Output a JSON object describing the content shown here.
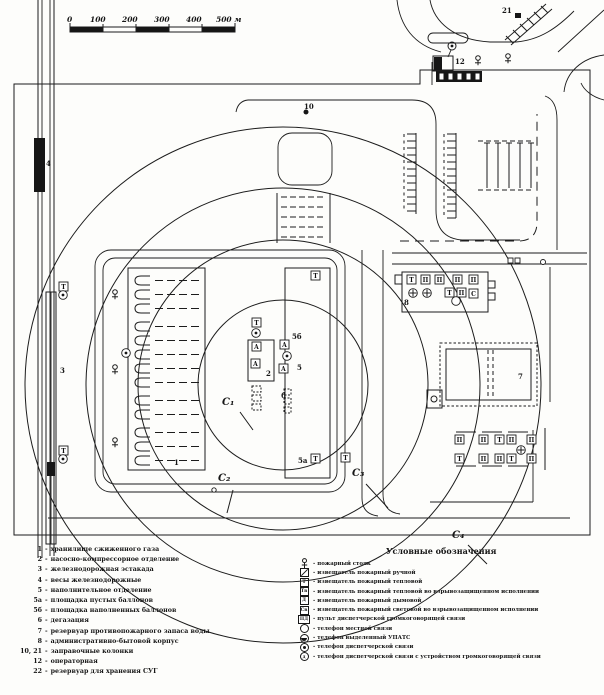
{
  "drawing": {
    "scale_bar": {
      "unit_labels": [
        "0",
        "100",
        "200",
        "300",
        "400",
        "500 м"
      ]
    },
    "map_labels": {
      "storage": "1",
      "pump": "2",
      "trestle": "3",
      "scales": "4",
      "filling": "5",
      "empty_area": "5а",
      "full_area": "5б",
      "degas": "6",
      "reservoir": "7",
      "admin": "8",
      "column10": "10",
      "operator": "12",
      "column21": "21"
    },
    "zones": {
      "z1": "С₁",
      "z2": "С₂",
      "z3": "С₃",
      "z4": "С₄"
    }
  },
  "icons": {
    "thermal": "Т",
    "thermal_ex": "Тв",
    "smoke": "Д",
    "light_ex": "Св",
    "panel": "ПД",
    "auto": "А",
    "pozh": "П",
    "svet": "С",
    "gg": "д"
  },
  "legend_left": {
    "sep": "-",
    "items": [
      {
        "num": "1",
        "text": "хранилище сжиженного газа"
      },
      {
        "num": "2",
        "text": "насосно-компрессорное отделение"
      },
      {
        "num": "3",
        "text": "железнодорожная эстакада"
      },
      {
        "num": "4",
        "text": "весы железнодорожные"
      },
      {
        "num": "5",
        "text": "наполнительное отделение"
      },
      {
        "num": "5а",
        "text": "площадка пустых баллонов"
      },
      {
        "num": "5б",
        "text": "площадка наполненных баллонов"
      },
      {
        "num": "6",
        "text": "дегазация"
      },
      {
        "num": "7",
        "text": "резервуар противопожарного запаса воды"
      },
      {
        "num": "8",
        "text": "административно-бытовой корпус"
      },
      {
        "num": "10, 21",
        "text": "заправочные колонки"
      },
      {
        "num": "12",
        "text": "операторная"
      },
      {
        "num": "22",
        "text": "резервуар для хранения СУГ"
      }
    ]
  },
  "legend_right": {
    "title": "Условные обозначения",
    "sep": "-",
    "items": [
      {
        "icon": "hydrant",
        "text": "пожарный стояк"
      },
      {
        "icon": "manual",
        "text": "извещатель пожарный ручной"
      },
      {
        "icon": "thermal",
        "text": "извещатель пожарный тепловой"
      },
      {
        "icon": "thermal-ex",
        "text": "извещатель пожарный тепловой во взрывозащищенном исполнении"
      },
      {
        "icon": "smoke",
        "text": "извещатель пожарный дымовой"
      },
      {
        "icon": "light-ex",
        "text": "извещатель пожарный световой во взрывозащищенном исполнении"
      },
      {
        "icon": "panel",
        "text": "пульт диспетчерской громкоговорящей связи"
      },
      {
        "icon": "phone-local",
        "text": "телефон местной связи"
      },
      {
        "icon": "phone-upats",
        "text": "телефон выделенный УПАТС"
      },
      {
        "icon": "phone-disp",
        "text": "телефон диспетчерской связи"
      },
      {
        "icon": "phone-disp-gg",
        "text": "телефон диспетчерской связи с устройством громкоговорящей связи"
      }
    ]
  }
}
